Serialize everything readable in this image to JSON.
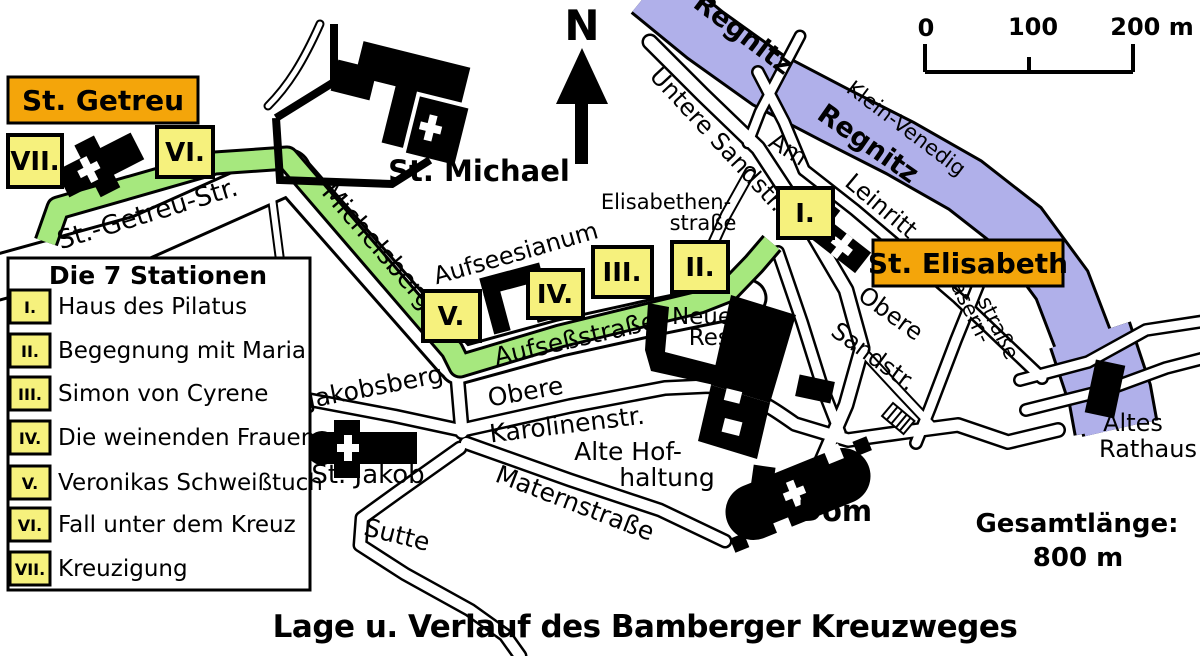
{
  "title": "Lage u. Verlauf des Bamberger Kreuzweges",
  "colors": {
    "route_green": "#a6e87e",
    "river_blue": "#b0b0ea",
    "station_yellow": "#f6f17d",
    "label_orange": "#f4a50a"
  },
  "legend": {
    "title": "Die 7 Stationen",
    "stations": [
      {
        "num": "I.",
        "name": "Haus des Pilatus"
      },
      {
        "num": "II.",
        "name": "Begegnung mit Maria"
      },
      {
        "num": "III.",
        "name": "Simon von Cyrene"
      },
      {
        "num": "IV.",
        "name": "Die weinenden Frauen"
      },
      {
        "num": "V.",
        "name": "Veronikas Schweißtuch"
      },
      {
        "num": "VI.",
        "name": "Fall unter dem Kreuz"
      },
      {
        "num": "VII.",
        "name": "Kreuzigung"
      }
    ]
  },
  "places": {
    "st_getreu": "St. Getreu",
    "st_michael": "St. Michael",
    "st_elisabeth": "St. Elisabeth",
    "st_jakob": "St. Jakob",
    "dom": "Dom",
    "aufseesianum": "Aufseesianum",
    "neue_res_1": "Neue",
    "neue_res_2": "Res.",
    "alte_hof_1": "Alte Hof-",
    "alte_hof_2": "haltung",
    "altes_rathaus_1": "Altes",
    "altes_rathaus_2": "Rathaus"
  },
  "streets": {
    "st_getreu_str": "St.-Getreu-Str.",
    "michelsberg": "Michelsberg",
    "jakobsberg": "Jakobsberg",
    "aufsessstrasse": "Aufseßstraße",
    "obere": "Obere",
    "karolinenstr": "Karolinenstr.",
    "maternstrasse": "Maternstraße",
    "sutte": "Sutte",
    "untere_sandstr": "Untere Sandstr.",
    "am": "Am",
    "leinritt": "Leinritt",
    "elisabethen_1": "Elisabethen-",
    "elisabethen_2": "straße",
    "obere_sand_1": "Obere",
    "obere_sand_2": "Sandstr.",
    "kasern_1": "Kasern-",
    "kasern_2": "straße",
    "klein_venedig": "Klein-Venedig"
  },
  "river": {
    "name": "Regnitz"
  },
  "compass": {
    "north": "N"
  },
  "scalebar": {
    "t0": "0",
    "t100": "100",
    "t200": "200 m"
  },
  "total_length": {
    "label": "Gesamtlänge:",
    "value": "800 m"
  }
}
